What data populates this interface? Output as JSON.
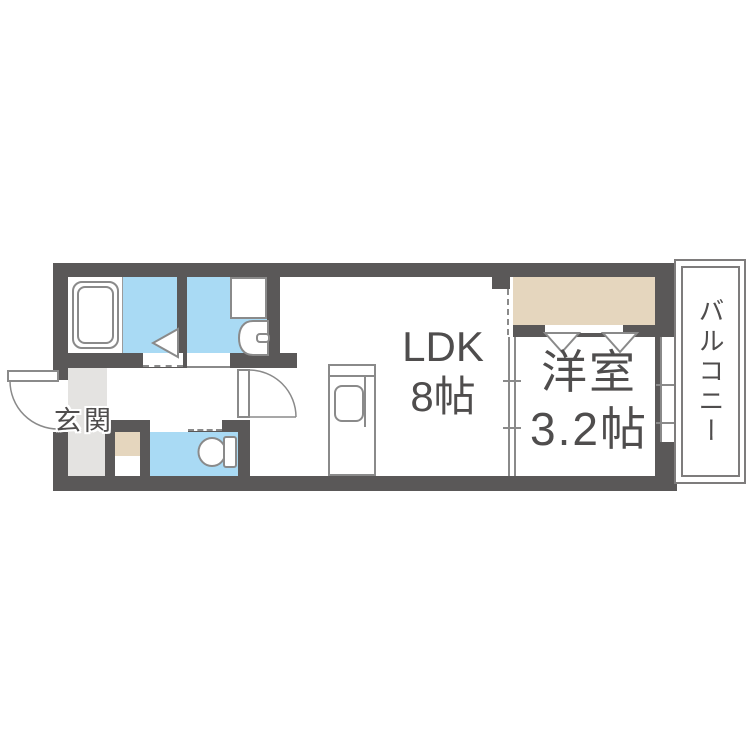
{
  "floorplan": {
    "rooms": {
      "ldk": {
        "name": "LDK",
        "size": "8帖"
      },
      "western_room": {
        "name": "洋室",
        "size": "3.2帖"
      },
      "balcony": {
        "name": "バルコニー"
      },
      "entrance": {
        "name": "玄関"
      }
    },
    "fixtures": [
      "bathtub",
      "washing-machine-pan",
      "washbasin",
      "toilet",
      "kitchen-counter",
      "kitchen-sink",
      "entry-door",
      "hallway-door",
      "bathroom-folding-door",
      "closet-folding-door",
      "sliding-partition",
      "window",
      "closet",
      "shoe-cabinet"
    ],
    "colors": {
      "wall": "#5a5858",
      "water_area": "#a9daf4",
      "storage": "#e5d6be",
      "entrance_floor": "#e4e3e1",
      "fixture_line": "#8a8a8a",
      "balcony_border": "#7e7c7c",
      "label_text": "#4f4d4d"
    }
  }
}
